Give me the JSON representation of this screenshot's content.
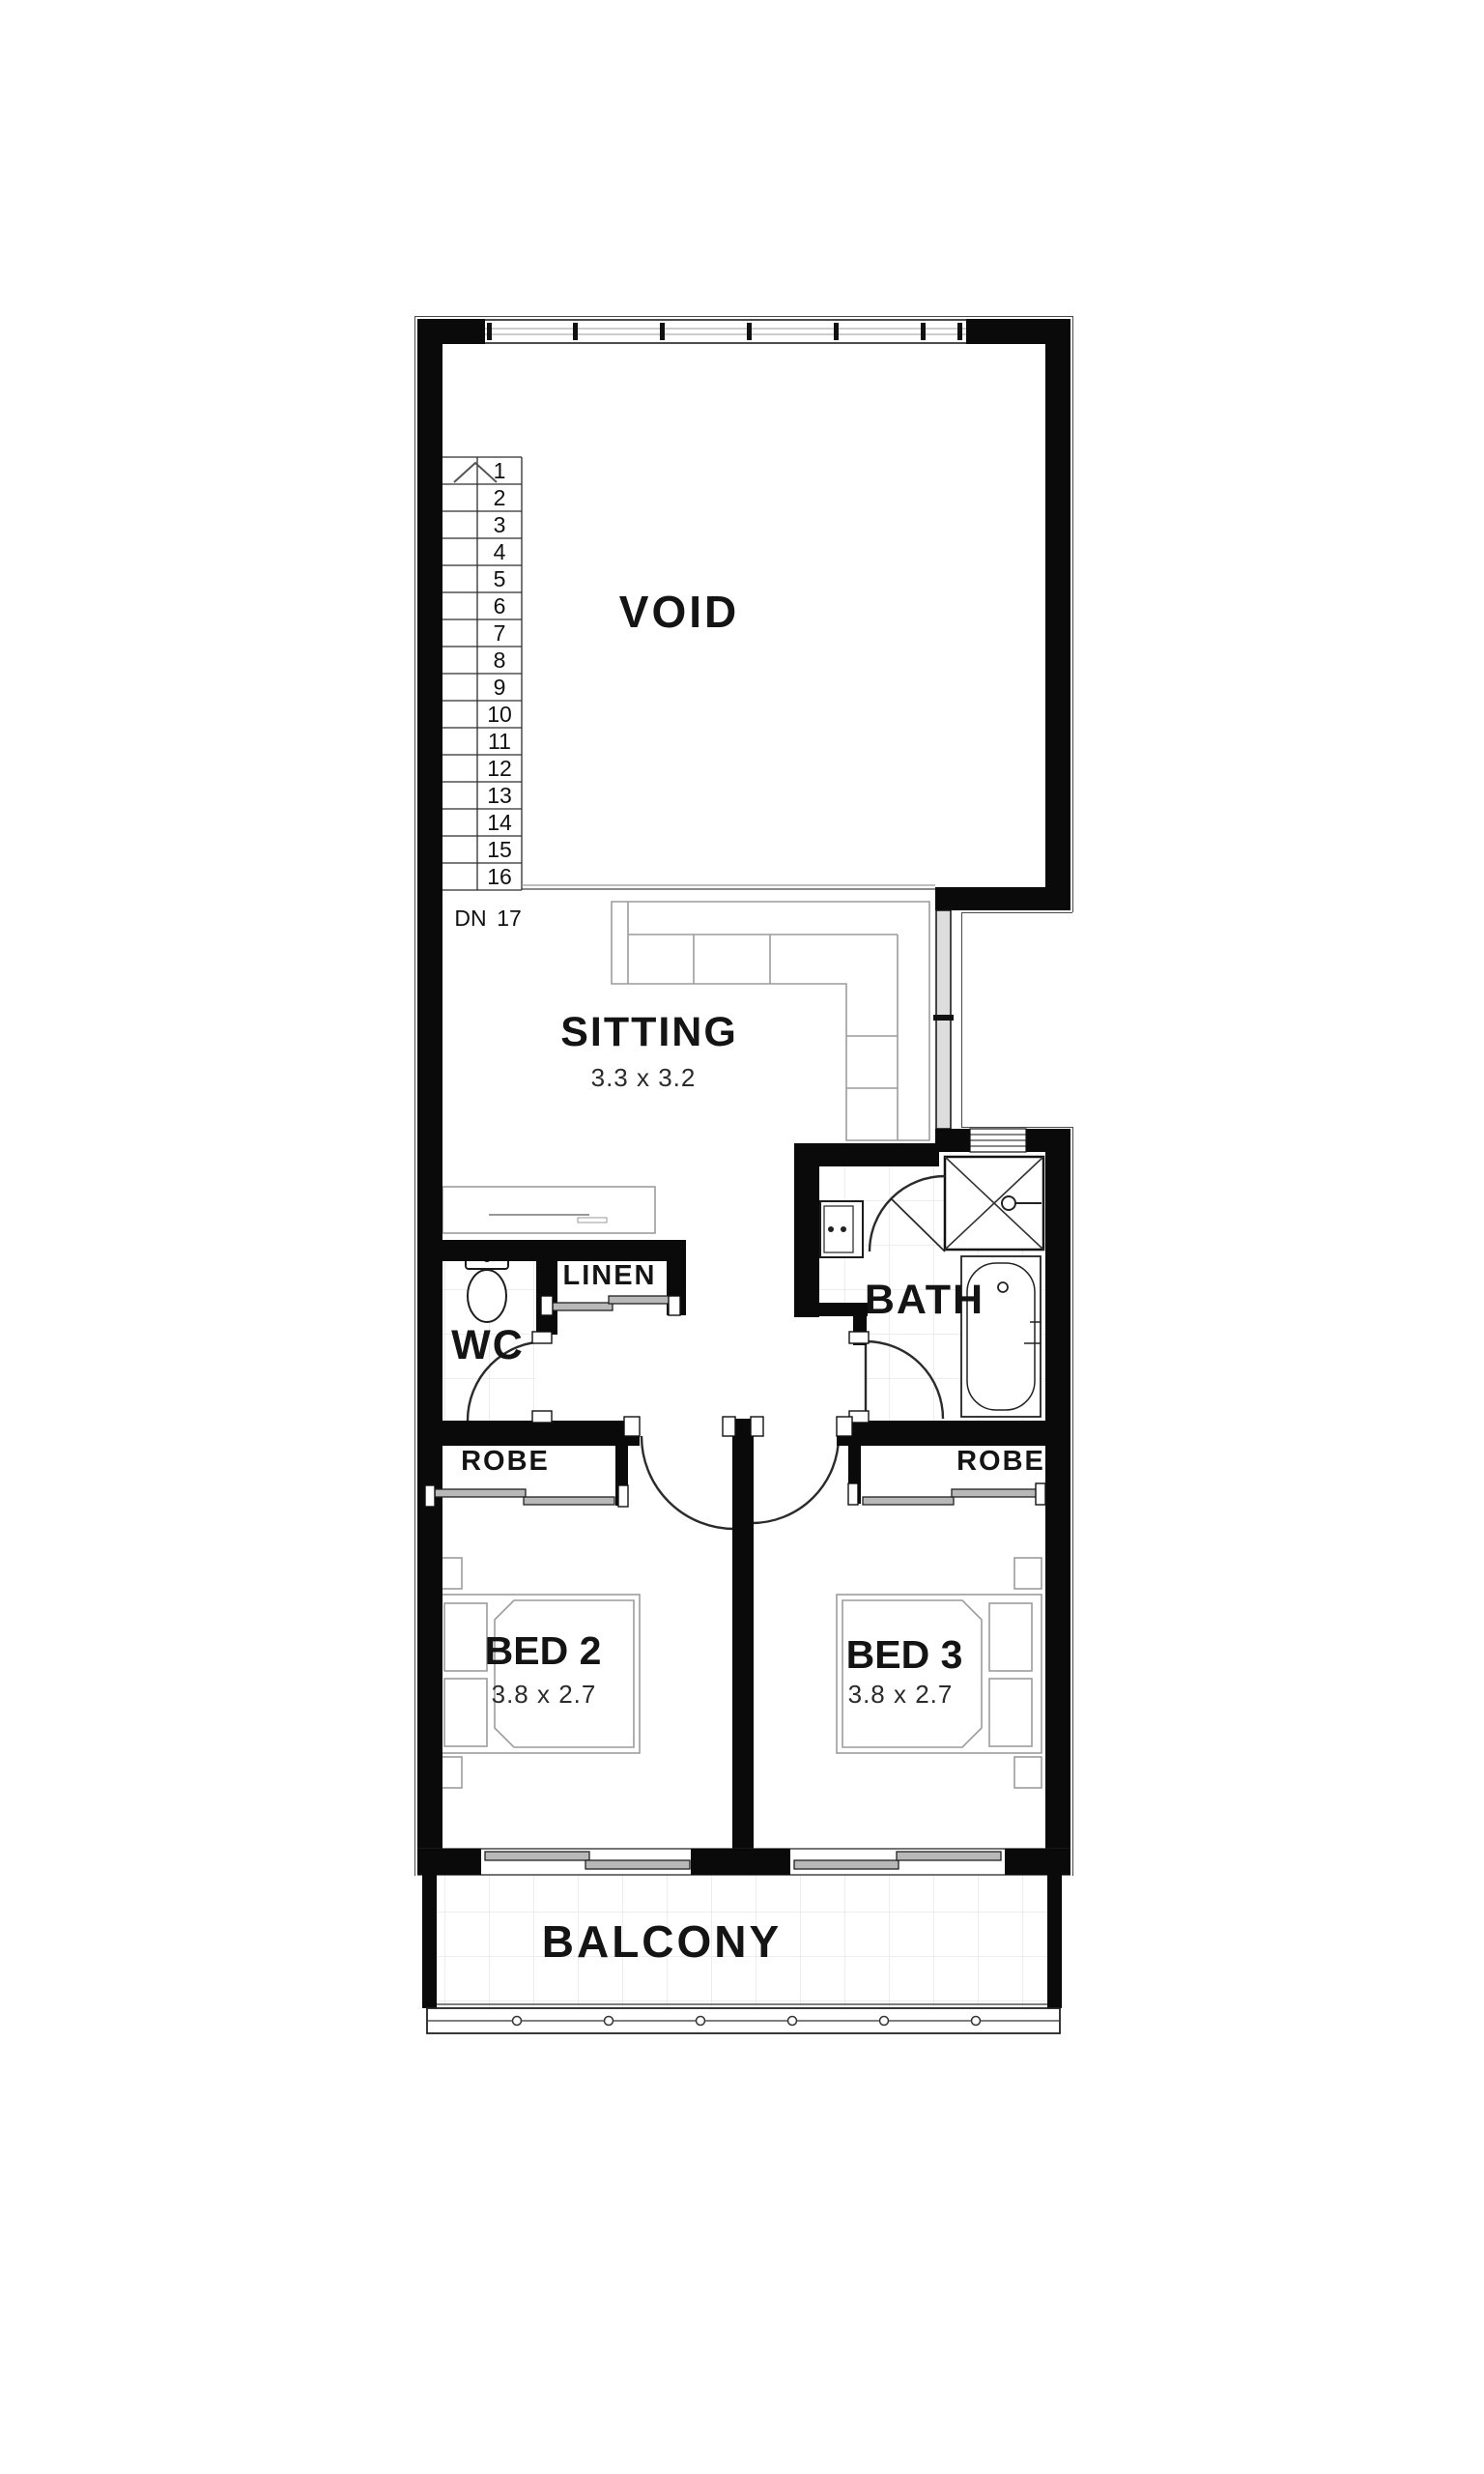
{
  "plan": {
    "rooms": {
      "void": {
        "label": "VOID"
      },
      "sitting": {
        "label": "SITTING",
        "dimensions": "3.3 x 3.2"
      },
      "wc": {
        "label": "WC"
      },
      "linen": {
        "label": "LINEN"
      },
      "bath": {
        "label": "BATH"
      },
      "robe_bed2": {
        "label": "ROBE"
      },
      "robe_bed3": {
        "label": "ROBE"
      },
      "bed2": {
        "label": "BED 2",
        "dimensions": "3.8 x 2.7"
      },
      "bed3": {
        "label": "BED 3",
        "dimensions": "3.8 x 2.7"
      },
      "balcony": {
        "label": "BALCONY"
      }
    },
    "stairs": {
      "treads": [
        "1",
        "2",
        "3",
        "4",
        "5",
        "6",
        "7",
        "8",
        "9",
        "10",
        "11",
        "12",
        "13",
        "14",
        "15",
        "16"
      ],
      "down_label": "DN",
      "last_tread": "17"
    },
    "colors": {
      "wall": "#0a0a0a",
      "furniture_line": "#9c9c9c",
      "tile_line": "#e7e7e7",
      "label": "#141414"
    }
  }
}
